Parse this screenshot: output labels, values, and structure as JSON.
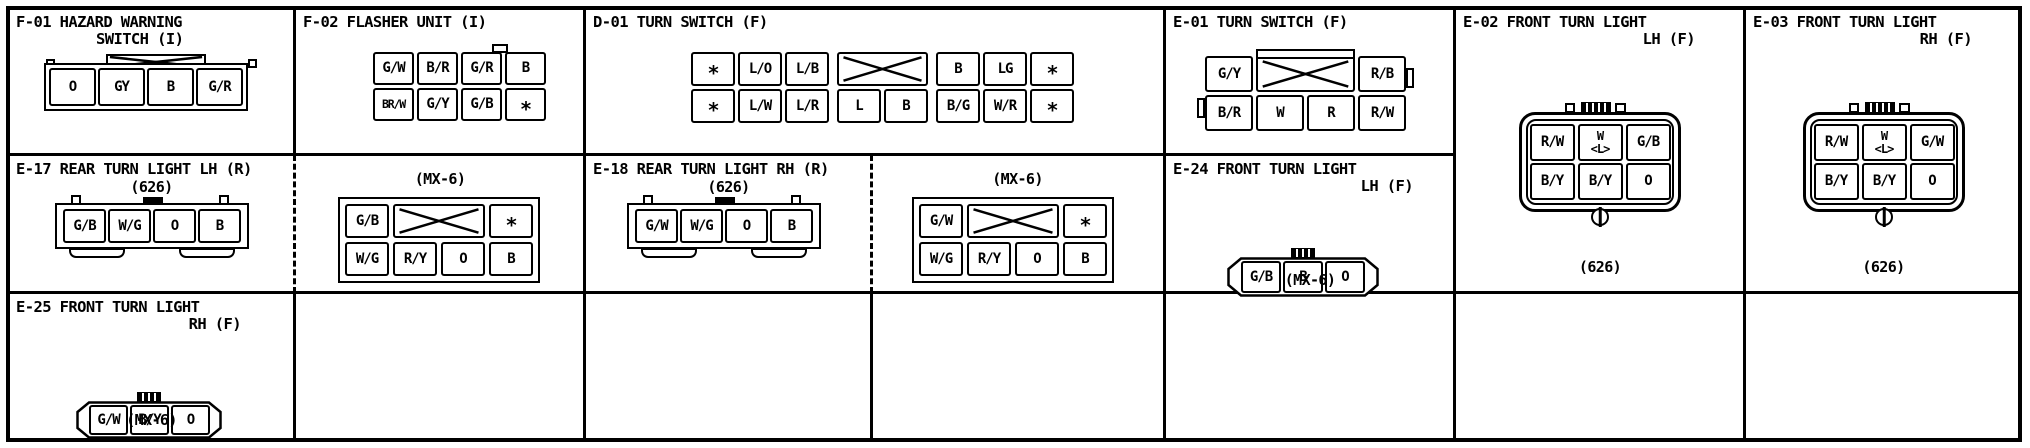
{
  "colors": {
    "ink": "#000000",
    "paper": "#ffffff"
  },
  "panels": {
    "f01": {
      "title1": "F-01 HAZARD WARNING",
      "title2": "SWITCH (I)",
      "grid": [
        [
          "O",
          "GY",
          "B",
          "G/R"
        ]
      ]
    },
    "f02": {
      "title1": "F-02 FLASHER UNIT (I)",
      "grid": [
        [
          "G/W",
          "B/R",
          "G/R",
          "B"
        ],
        [
          "BR/W",
          "G/Y",
          "G/B",
          "*"
        ]
      ]
    },
    "d01": {
      "title1": "D-01 TURN SWITCH (F)",
      "grid_left": [
        [
          "*",
          "L/O",
          "L/B"
        ],
        [
          "*",
          "L/W",
          "L/R"
        ]
      ],
      "grid_mid": [
        [
          {
            "x": 2
          }
        ],
        [
          "L",
          "B"
        ]
      ],
      "grid_right": [
        [
          "B",
          "LG",
          "*"
        ],
        [
          "B/G",
          "W/R",
          "*"
        ]
      ]
    },
    "e01": {
      "title1": "E-01 TURN SWITCH (F)",
      "grid": [
        [
          "G/Y",
          {
            "x": 2
          },
          "R/B"
        ],
        [
          "B/R",
          "W",
          "R",
          "R/W"
        ]
      ]
    },
    "e02": {
      "title1": "E-02 FRONT TURN LIGHT",
      "title2": "LH (F)",
      "variant": "(626)",
      "grid": [
        [
          "R/W",
          "W\n<L>",
          "G/B"
        ],
        [
          "B/Y",
          "B/Y",
          "O"
        ]
      ]
    },
    "e03": {
      "title1": "E-03 FRONT TURN LIGHT",
      "title2": "RH (F)",
      "variant": "(626)",
      "grid": [
        [
          "R/W",
          "W\n<L>",
          "G/W"
        ],
        [
          "B/Y",
          "B/Y",
          "O"
        ]
      ]
    },
    "e17": {
      "title1": "E-17 REAR TURN LIGHT LH (R)",
      "variant": "(626)",
      "grid": [
        [
          "G/B",
          "W/G",
          "O",
          "B"
        ]
      ]
    },
    "e17mx": {
      "variant": "(MX-6)",
      "grid": [
        [
          "G/B",
          {
            "x": 2
          },
          "*"
        ],
        [
          "W/G",
          "R/Y",
          "O",
          "B"
        ]
      ]
    },
    "e18": {
      "title1": "E-18 REAR TURN LIGHT RH (R)",
      "variant": "(626)",
      "grid": [
        [
          "G/W",
          "W/G",
          "O",
          "B"
        ]
      ]
    },
    "e18mx": {
      "variant": "(MX-6)",
      "grid": [
        [
          "G/W",
          {
            "x": 2
          },
          "*"
        ],
        [
          "W/G",
          "R/Y",
          "O",
          "B"
        ]
      ]
    },
    "e24": {
      "title1": "E-24 FRONT TURN LIGHT",
      "title2": "LH (F)",
      "variant": "(MX-6)",
      "grid": [
        [
          "G/B",
          "B",
          "O"
        ]
      ]
    },
    "e25": {
      "title1": "E-25 FRONT TURN LIGHT",
      "title2": "RH (F)",
      "variant": "(MX-6)",
      "grid": [
        [
          "G/W",
          "B/Y",
          "O"
        ]
      ]
    }
  }
}
